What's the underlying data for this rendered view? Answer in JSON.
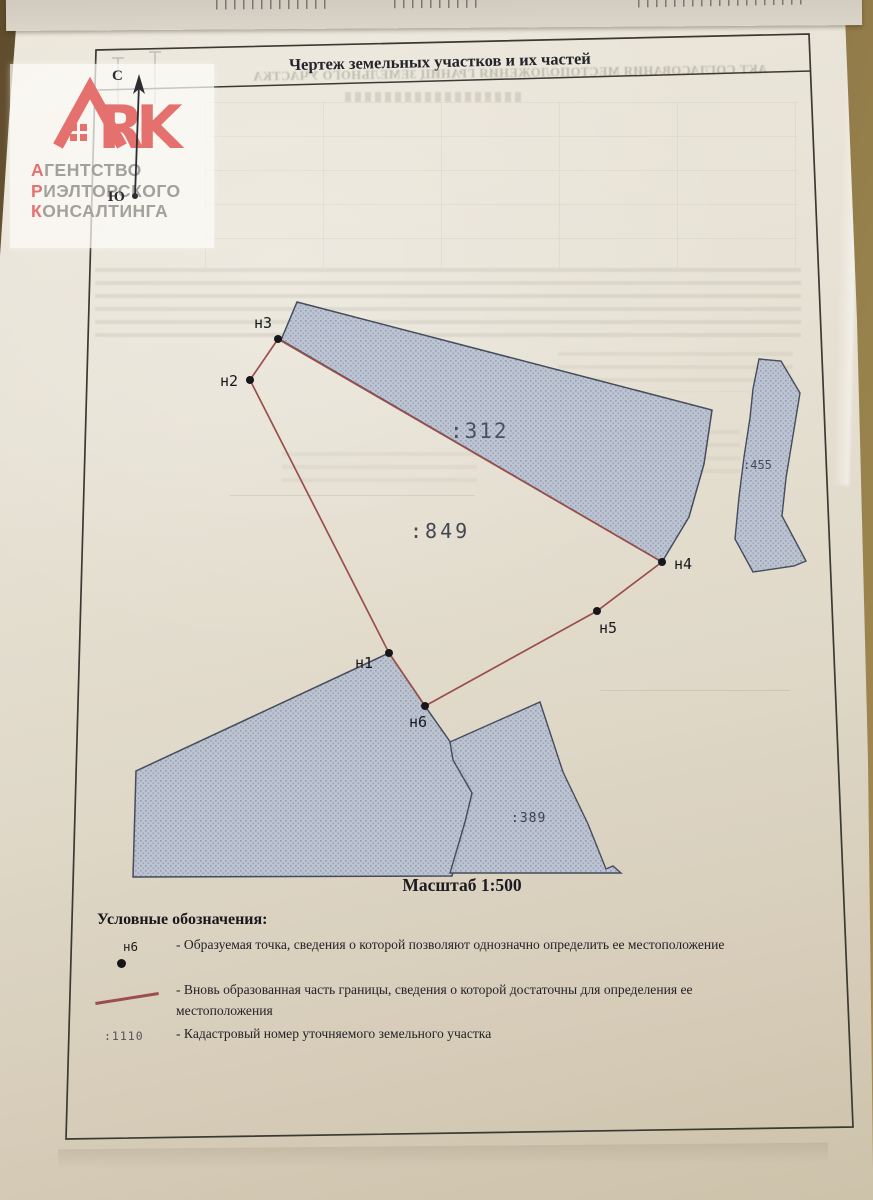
{
  "document": {
    "title": "Чертеж земельных участков и их частей",
    "scale_label": "Масштаб 1:500",
    "compass": {
      "north": "С",
      "south": "Ю"
    }
  },
  "watermark": {
    "brand": "ARK",
    "letter_r": "R",
    "letter_k": "K",
    "lines": [
      {
        "initial": "А",
        "rest": "ГЕНТСТВО"
      },
      {
        "initial": "Р",
        "rest": "ИЭЛТОРСКОГО"
      },
      {
        "initial": "К",
        "rest": "ОНСАЛТИНГА"
      }
    ]
  },
  "map": {
    "points": [
      {
        "id": "н1"
      },
      {
        "id": "н2"
      },
      {
        "id": "н3"
      },
      {
        "id": "н4"
      },
      {
        "id": "н5"
      },
      {
        "id": "н6"
      }
    ],
    "parcel_labels": [
      {
        "number": ":312"
      },
      {
        "number": ":849"
      },
      {
        "number": ":455"
      },
      {
        "number": ":389"
      }
    ]
  },
  "legend": {
    "heading": "Условные обозначения:",
    "items": [
      {
        "symbol_label": "н6",
        "text": "- Образуемая точка, сведения о которой позволяют однозначно определить ее местоположение"
      },
      {
        "text": "- Вновь образованная часть границы, сведения о которой достаточны для определения ее местоположения"
      },
      {
        "symbol_label": ":1110",
        "text": "- Кадастровый номер уточняемого земельного участка"
      }
    ]
  },
  "bleedthrough": {
    "reversed_title": "АКТ СОГЛАСОВАНИЯ МЕСТОПОЛОЖЕНИЯ ГРАНИЦ ЗЕМЕЛЬНОГО УЧАСТКА"
  },
  "colors": {
    "boundary_red": "#9a4f4c",
    "parcel_fill": "#b9c2d3",
    "parcel_stroke": "#454c5c",
    "watermark_red": "#e4716e",
    "desk_brown": "#7a6239"
  }
}
